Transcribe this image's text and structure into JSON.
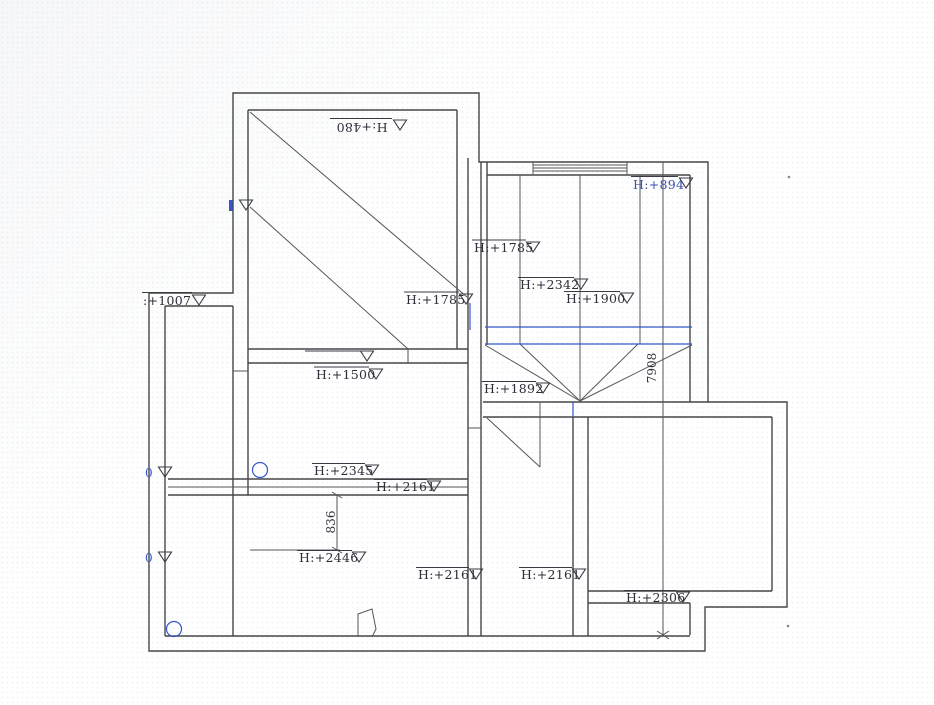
{
  "colors": {
    "wall_line": "#474747",
    "thin_line": "#565656",
    "accent_blue": "#3457c9",
    "label_text": "#2e2e3a",
    "blue_label_text": "#3a50b4"
  },
  "level_markers": [
    {
      "id": "h480",
      "text": "H:+480",
      "note": "rotated-180"
    },
    {
      "id": "h894",
      "text": "H:+894"
    },
    {
      "id": "h1007",
      "text": ":+1007"
    },
    {
      "id": "h1785-left",
      "text": "H:+1785"
    },
    {
      "id": "h1785-right",
      "text": "H:+1785"
    },
    {
      "id": "h2342",
      "text": "H:+2342"
    },
    {
      "id": "h1900",
      "text": "H:+1900"
    },
    {
      "id": "h1500",
      "text": "H:+1500"
    },
    {
      "id": "h1892",
      "text": "H:+1892"
    },
    {
      "id": "h2345",
      "text": "H:+2345"
    },
    {
      "id": "h2161-upper",
      "text": "H:+2161"
    },
    {
      "id": "h2446",
      "text": "H:+2446"
    },
    {
      "id": "h2161-lower-left",
      "text": "H:+2161"
    },
    {
      "id": "h2161-lower-right",
      "text": "H:+2161"
    },
    {
      "id": "h2306",
      "text": "H:+2306"
    }
  ],
  "dimensions": [
    {
      "id": "dim-vertical-right",
      "text": "7908"
    },
    {
      "id": "dim-836",
      "text": "836"
    }
  ],
  "zero_markers": [
    {
      "id": "zero-upper",
      "text": "0"
    },
    {
      "id": "zero-lower",
      "text": "0"
    }
  ]
}
